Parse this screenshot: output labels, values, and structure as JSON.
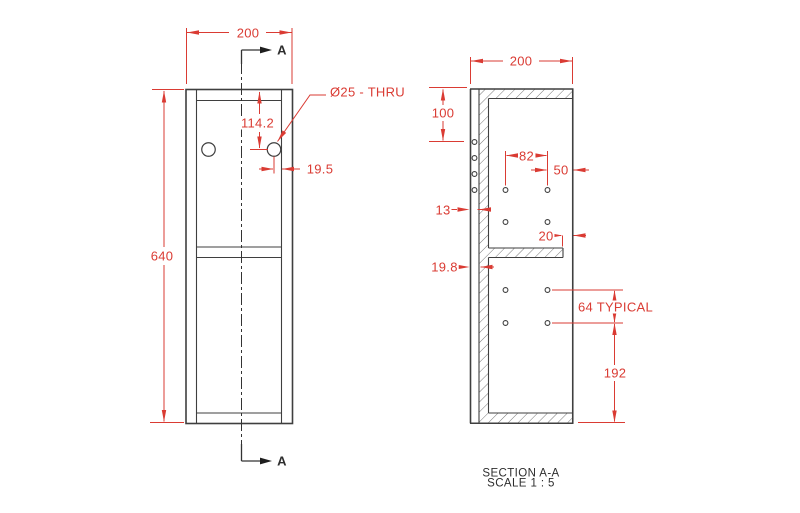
{
  "drawing": {
    "front": {
      "dim_width": "200",
      "dim_height": "640",
      "dim_hole_vertical": "114.2",
      "dim_hole_edge": "19.5",
      "hole_callout": "Ø25 - THRU",
      "section_marker": "A"
    },
    "section": {
      "dim_width": "200",
      "dim_top_hole": "100",
      "dim_hole_spacing": "82",
      "dim_edge_offset": "50",
      "dim_wall_thickness": "13",
      "dim_shelf_gap": "20",
      "dim_plate_thickness": "19.8",
      "dim_typical": "64 TYPICAL",
      "dim_bottom": "192"
    },
    "caption": {
      "title": "SECTION A-A",
      "scale": "SCALE 1 : 5"
    },
    "colors": {
      "dimension_red": "#da3b33",
      "geometry_line": "#3f3f3f",
      "background": "#ffffff"
    }
  }
}
